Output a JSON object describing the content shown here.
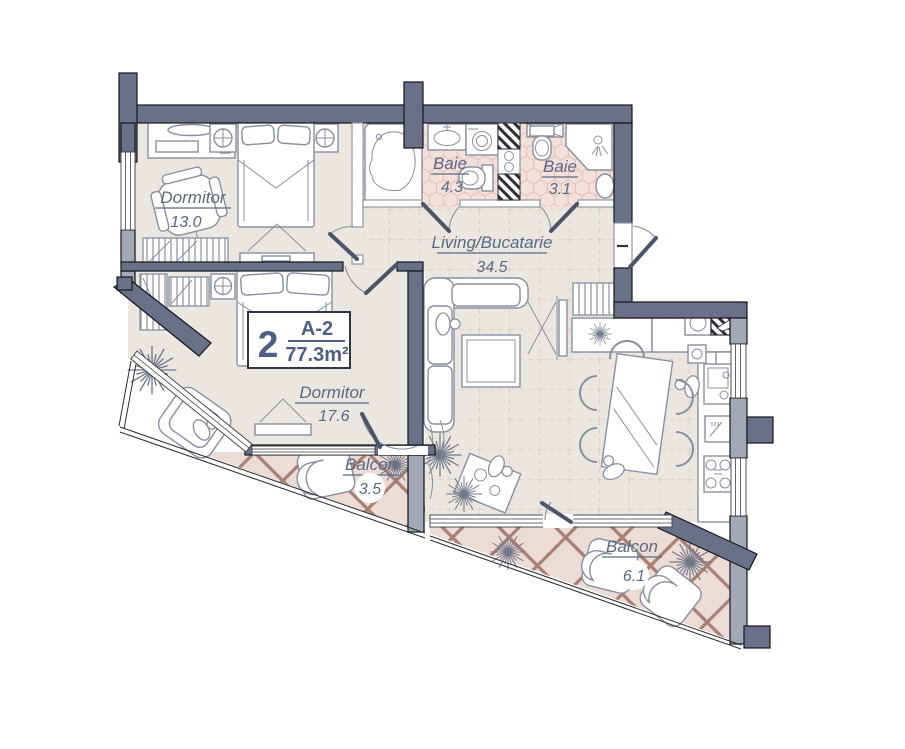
{
  "plan": {
    "unit_label": {
      "rooms": "2",
      "code": "A-2",
      "area": "77.3m²"
    },
    "rooms": {
      "dormitor1": {
        "name": "Dormitor",
        "area": "13.0"
      },
      "dormitor2": {
        "name": "Dormitor",
        "area": "17.6"
      },
      "baie1": {
        "name": "Baie",
        "area": "4.3"
      },
      "baie2": {
        "name": "Baie",
        "area": "3.1"
      },
      "living": {
        "name": "Living/Bucatarie",
        "area": "34.5"
      },
      "balcon1": {
        "name": "Balcon",
        "area": "3.5"
      },
      "balcon2": {
        "name": "Balcon",
        "area": "6.1"
      }
    },
    "entrance_mark": "–",
    "colors": {
      "wall_dark": "#6a7088",
      "wall_light": "#a3a8b6",
      "floor_beige": "#eae7e0",
      "bath_tile": "#f3e0da",
      "balcony_bg": "#ecdcd6",
      "lattice": "#a87f72",
      "label_text": "#5b6985"
    }
  }
}
